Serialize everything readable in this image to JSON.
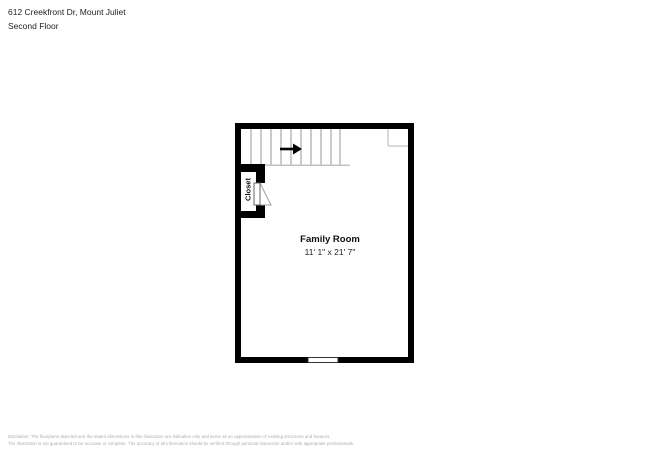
{
  "header": {
    "address": "612 Creekfront Dr, Mount Juliet",
    "floor": "Second Floor"
  },
  "floorplan": {
    "room": {
      "name": "Family Room",
      "dimensions": "11' 1\" x 21' 7\""
    },
    "closet_label": "Closet",
    "icons": {
      "stair_direction": "right-arrow-icon",
      "door": "door-swing-icon",
      "window": "window-icon"
    },
    "colors": {
      "wall": "#000000",
      "floor": "#ffffff",
      "stair_tread": "#979797",
      "stair_edge": "#c2c2c2",
      "niche_line": "#b5b5b5",
      "door_line": "#666666",
      "swing_line": "#a0a0a0",
      "window_line": "#333333"
    }
  },
  "footer": {
    "disclaimer_line1": "Disclaimer: The floorplans depicted and the stated dimensions in this illustration are indicative only and serve as an approximation of existing structures and features.",
    "disclaimer_line2": "The illustration is not guaranteed to be accurate or complete. The accuracy of all information should be verified through personal inspection and/or with appropriate professionals."
  }
}
